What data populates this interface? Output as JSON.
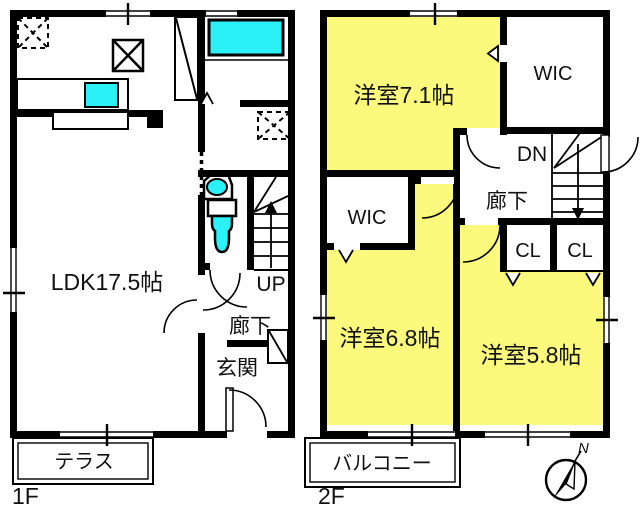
{
  "colors": {
    "room_yellow": "#FBFA7D",
    "fixture_cyan": "#2BF0F5",
    "wall_black": "#000000",
    "background": "#FFFFFF"
  },
  "floor1": {
    "name": "1F",
    "ldk": "LDK17.5帖",
    "hallway": "廊下",
    "entrance": "玄関",
    "terrace": "テラス",
    "stairs_up": "UP"
  },
  "floor2": {
    "name": "2F",
    "room_a": "洋室7.1帖",
    "room_b": "洋室6.8帖",
    "room_c": "洋室5.8帖",
    "wic_top": "WIC",
    "wic_left": "WIC",
    "closet_left": "CL",
    "closet_right": "CL",
    "stairs_down": "DN",
    "hallway": "廊下",
    "balcony": "バルコニー"
  },
  "compass": {
    "north": "N"
  }
}
